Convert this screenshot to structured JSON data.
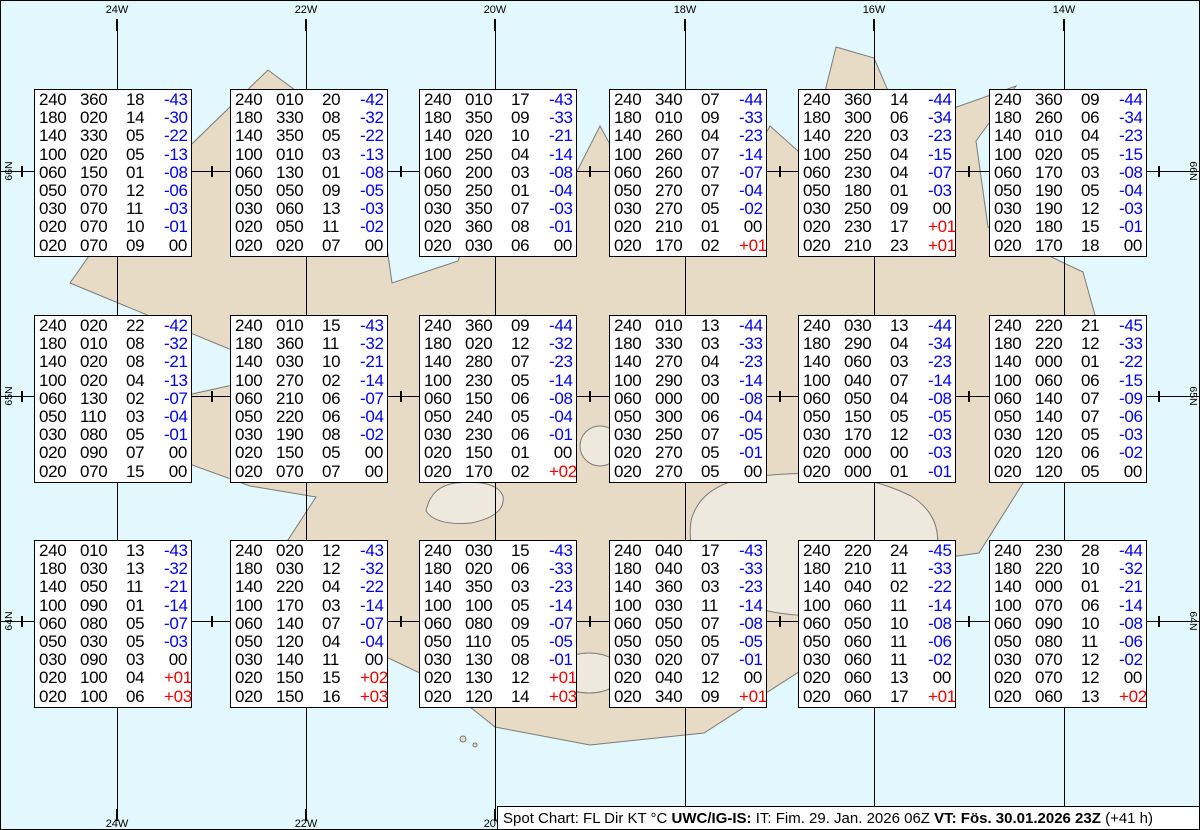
{
  "colors": {
    "ocean": "#e2f8fc",
    "land": "#e8dbc6",
    "coast": "#7a7a7a",
    "glacier": "#efe9dd",
    "grid": "#000000",
    "temp_neg": "#0000ee",
    "temp_pos": "#ee0000",
    "temp_zero": "#000000"
  },
  "grid": {
    "vlines": [
      {
        "x": 116,
        "label": "24W",
        "bottom_label": true
      },
      {
        "x": 305,
        "label": "22W",
        "bottom_label": true
      },
      {
        "x": 494,
        "label": "20W",
        "bottom_label": true
      },
      {
        "x": 684,
        "label": "18W",
        "bottom_label": false
      },
      {
        "x": 873,
        "label": "16W",
        "bottom_label": false
      },
      {
        "x": 1063,
        "label": "14W",
        "bottom_label": false
      }
    ],
    "hlines": [
      {
        "y": 170,
        "label": "66N"
      },
      {
        "y": 395,
        "label": "65N"
      },
      {
        "y": 620,
        "label": "64N"
      }
    ],
    "cross_xs": [
      21,
      211,
      400,
      589,
      779,
      968,
      1158
    ]
  },
  "boxes": [
    {
      "x": 33,
      "y": 88,
      "rows": [
        [
          "240",
          "360",
          "18",
          "-43"
        ],
        [
          "180",
          "020",
          "14",
          "-30"
        ],
        [
          "140",
          "330",
          "05",
          "-22"
        ],
        [
          "100",
          "020",
          "05",
          "-13"
        ],
        [
          "060",
          "150",
          "01",
          "-08"
        ],
        [
          "050",
          "070",
          "12",
          "-06"
        ],
        [
          "030",
          "070",
          "11",
          "-03"
        ],
        [
          "020",
          "070",
          "10",
          "-01"
        ],
        [
          "020",
          "070",
          "09",
          "00"
        ]
      ]
    },
    {
      "x": 229,
      "y": 88,
      "rows": [
        [
          "240",
          "010",
          "20",
          "-42"
        ],
        [
          "180",
          "330",
          "08",
          "-32"
        ],
        [
          "140",
          "350",
          "05",
          "-22"
        ],
        [
          "100",
          "010",
          "03",
          "-13"
        ],
        [
          "060",
          "130",
          "01",
          "-08"
        ],
        [
          "050",
          "050",
          "09",
          "-05"
        ],
        [
          "030",
          "060",
          "13",
          "-03"
        ],
        [
          "020",
          "050",
          "11",
          "-02"
        ],
        [
          "020",
          "020",
          "07",
          "00"
        ]
      ]
    },
    {
      "x": 418,
      "y": 88,
      "rows": [
        [
          "240",
          "010",
          "17",
          "-43"
        ],
        [
          "180",
          "350",
          "09",
          "-33"
        ],
        [
          "140",
          "020",
          "10",
          "-21"
        ],
        [
          "100",
          "250",
          "04",
          "-14"
        ],
        [
          "060",
          "200",
          "03",
          "-08"
        ],
        [
          "050",
          "250",
          "01",
          "-04"
        ],
        [
          "030",
          "350",
          "07",
          "-03"
        ],
        [
          "020",
          "360",
          "08",
          "-01"
        ],
        [
          "020",
          "030",
          "06",
          "00"
        ]
      ]
    },
    {
      "x": 608,
      "y": 88,
      "rows": [
        [
          "240",
          "340",
          "07",
          "-44"
        ],
        [
          "180",
          "010",
          "09",
          "-33"
        ],
        [
          "140",
          "260",
          "04",
          "-23"
        ],
        [
          "100",
          "260",
          "07",
          "-14"
        ],
        [
          "060",
          "260",
          "07",
          "-07"
        ],
        [
          "050",
          "270",
          "07",
          "-04"
        ],
        [
          "030",
          "270",
          "05",
          "-02"
        ],
        [
          "020",
          "210",
          "01",
          "00"
        ],
        [
          "020",
          "170",
          "02",
          "+01"
        ]
      ]
    },
    {
      "x": 797,
      "y": 88,
      "rows": [
        [
          "240",
          "360",
          "14",
          "-44"
        ],
        [
          "180",
          "300",
          "06",
          "-34"
        ],
        [
          "140",
          "220",
          "03",
          "-23"
        ],
        [
          "100",
          "250",
          "04",
          "-15"
        ],
        [
          "060",
          "230",
          "04",
          "-07"
        ],
        [
          "050",
          "180",
          "01",
          "-03"
        ],
        [
          "030",
          "250",
          "09",
          "00"
        ],
        [
          "020",
          "230",
          "17",
          "+01"
        ],
        [
          "020",
          "210",
          "23",
          "+01"
        ]
      ]
    },
    {
      "x": 988,
      "y": 88,
      "rows": [
        [
          "240",
          "360",
          "09",
          "-44"
        ],
        [
          "180",
          "260",
          "06",
          "-34"
        ],
        [
          "140",
          "010",
          "04",
          "-23"
        ],
        [
          "100",
          "020",
          "05",
          "-15"
        ],
        [
          "060",
          "170",
          "03",
          "-08"
        ],
        [
          "050",
          "190",
          "05",
          "-04"
        ],
        [
          "030",
          "190",
          "12",
          "-03"
        ],
        [
          "020",
          "180",
          "15",
          "-01"
        ],
        [
          "020",
          "170",
          "18",
          "00"
        ]
      ]
    },
    {
      "x": 33,
      "y": 314,
      "rows": [
        [
          "240",
          "020",
          "22",
          "-42"
        ],
        [
          "180",
          "010",
          "08",
          "-32"
        ],
        [
          "140",
          "020",
          "08",
          "-21"
        ],
        [
          "100",
          "020",
          "04",
          "-13"
        ],
        [
          "060",
          "130",
          "02",
          "-07"
        ],
        [
          "050",
          "110",
          "03",
          "-04"
        ],
        [
          "030",
          "080",
          "05",
          "-01"
        ],
        [
          "020",
          "090",
          "07",
          "00"
        ],
        [
          "020",
          "070",
          "15",
          "00"
        ]
      ]
    },
    {
      "x": 229,
      "y": 314,
      "rows": [
        [
          "240",
          "010",
          "15",
          "-43"
        ],
        [
          "180",
          "360",
          "11",
          "-32"
        ],
        [
          "140",
          "030",
          "10",
          "-21"
        ],
        [
          "100",
          "270",
          "02",
          "-14"
        ],
        [
          "060",
          "210",
          "06",
          "-07"
        ],
        [
          "050",
          "220",
          "06",
          "-04"
        ],
        [
          "030",
          "190",
          "08",
          "-02"
        ],
        [
          "020",
          "150",
          "05",
          "00"
        ],
        [
          "020",
          "070",
          "07",
          "00"
        ]
      ]
    },
    {
      "x": 418,
      "y": 314,
      "rows": [
        [
          "240",
          "360",
          "09",
          "-44"
        ],
        [
          "180",
          "020",
          "12",
          "-32"
        ],
        [
          "140",
          "280",
          "07",
          "-23"
        ],
        [
          "100",
          "230",
          "05",
          "-14"
        ],
        [
          "060",
          "150",
          "06",
          "-08"
        ],
        [
          "050",
          "240",
          "05",
          "-04"
        ],
        [
          "030",
          "230",
          "06",
          "-01"
        ],
        [
          "020",
          "150",
          "01",
          "00"
        ],
        [
          "020",
          "170",
          "02",
          "+02"
        ]
      ]
    },
    {
      "x": 608,
      "y": 314,
      "rows": [
        [
          "240",
          "010",
          "13",
          "-44"
        ],
        [
          "180",
          "330",
          "03",
          "-33"
        ],
        [
          "140",
          "270",
          "04",
          "-23"
        ],
        [
          "100",
          "290",
          "03",
          "-14"
        ],
        [
          "060",
          "000",
          "00",
          "-08"
        ],
        [
          "050",
          "300",
          "06",
          "-04"
        ],
        [
          "030",
          "250",
          "07",
          "-05"
        ],
        [
          "020",
          "270",
          "05",
          "-01"
        ],
        [
          "020",
          "270",
          "05",
          "00"
        ]
      ]
    },
    {
      "x": 797,
      "y": 314,
      "rows": [
        [
          "240",
          "030",
          "13",
          "-44"
        ],
        [
          "180",
          "290",
          "04",
          "-34"
        ],
        [
          "140",
          "060",
          "03",
          "-23"
        ],
        [
          "100",
          "040",
          "07",
          "-14"
        ],
        [
          "060",
          "050",
          "04",
          "-08"
        ],
        [
          "050",
          "150",
          "05",
          "-05"
        ],
        [
          "030",
          "170",
          "12",
          "-03"
        ],
        [
          "020",
          "000",
          "00",
          "-03"
        ],
        [
          "020",
          "000",
          "01",
          "-01"
        ]
      ]
    },
    {
      "x": 988,
      "y": 314,
      "rows": [
        [
          "240",
          "220",
          "21",
          "-45"
        ],
        [
          "180",
          "220",
          "12",
          "-33"
        ],
        [
          "140",
          "000",
          "01",
          "-22"
        ],
        [
          "100",
          "060",
          "06",
          "-15"
        ],
        [
          "060",
          "140",
          "07",
          "-09"
        ],
        [
          "050",
          "140",
          "07",
          "-06"
        ],
        [
          "030",
          "120",
          "05",
          "-03"
        ],
        [
          "020",
          "120",
          "06",
          "-02"
        ],
        [
          "020",
          "120",
          "05",
          "00"
        ]
      ]
    },
    {
      "x": 33,
      "y": 539,
      "rows": [
        [
          "240",
          "010",
          "13",
          "-43"
        ],
        [
          "180",
          "030",
          "13",
          "-32"
        ],
        [
          "140",
          "050",
          "11",
          "-21"
        ],
        [
          "100",
          "090",
          "01",
          "-14"
        ],
        [
          "060",
          "080",
          "05",
          "-07"
        ],
        [
          "050",
          "030",
          "05",
          "-03"
        ],
        [
          "030",
          "090",
          "03",
          "00"
        ],
        [
          "020",
          "100",
          "04",
          "+01"
        ],
        [
          "020",
          "100",
          "06",
          "+03"
        ]
      ]
    },
    {
      "x": 229,
      "y": 539,
      "rows": [
        [
          "240",
          "020",
          "12",
          "-43"
        ],
        [
          "180",
          "030",
          "12",
          "-32"
        ],
        [
          "140",
          "220",
          "04",
          "-22"
        ],
        [
          "100",
          "170",
          "03",
          "-14"
        ],
        [
          "060",
          "140",
          "07",
          "-07"
        ],
        [
          "050",
          "120",
          "04",
          "-04"
        ],
        [
          "030",
          "140",
          "11",
          "00"
        ],
        [
          "020",
          "150",
          "15",
          "+02"
        ],
        [
          "020",
          "150",
          "16",
          "+03"
        ]
      ]
    },
    {
      "x": 418,
      "y": 539,
      "rows": [
        [
          "240",
          "030",
          "15",
          "-43"
        ],
        [
          "180",
          "020",
          "06",
          "-33"
        ],
        [
          "140",
          "350",
          "03",
          "-23"
        ],
        [
          "100",
          "100",
          "05",
          "-14"
        ],
        [
          "060",
          "080",
          "09",
          "-07"
        ],
        [
          "050",
          "110",
          "05",
          "-05"
        ],
        [
          "030",
          "130",
          "08",
          "-01"
        ],
        [
          "020",
          "130",
          "12",
          "+01"
        ],
        [
          "020",
          "120",
          "14",
          "+03"
        ]
      ]
    },
    {
      "x": 608,
      "y": 539,
      "rows": [
        [
          "240",
          "040",
          "17",
          "-43"
        ],
        [
          "180",
          "040",
          "03",
          "-33"
        ],
        [
          "140",
          "360",
          "03",
          "-23"
        ],
        [
          "100",
          "030",
          "11",
          "-14"
        ],
        [
          "060",
          "050",
          "07",
          "-08"
        ],
        [
          "050",
          "050",
          "05",
          "-05"
        ],
        [
          "030",
          "020",
          "07",
          "-01"
        ],
        [
          "020",
          "040",
          "12",
          "00"
        ],
        [
          "020",
          "340",
          "09",
          "+01"
        ]
      ]
    },
    {
      "x": 797,
      "y": 539,
      "rows": [
        [
          "240",
          "220",
          "24",
          "-45"
        ],
        [
          "180",
          "210",
          "11",
          "-33"
        ],
        [
          "140",
          "040",
          "02",
          "-22"
        ],
        [
          "100",
          "060",
          "11",
          "-14"
        ],
        [
          "060",
          "050",
          "10",
          "-08"
        ],
        [
          "050",
          "060",
          "11",
          "-06"
        ],
        [
          "030",
          "060",
          "11",
          "-02"
        ],
        [
          "020",
          "060",
          "13",
          "00"
        ],
        [
          "020",
          "060",
          "17",
          "+01"
        ]
      ]
    },
    {
      "x": 988,
      "y": 539,
      "rows": [
        [
          "240",
          "230",
          "28",
          "-44"
        ],
        [
          "180",
          "220",
          "10",
          "-32"
        ],
        [
          "140",
          "000",
          "01",
          "-21"
        ],
        [
          "100",
          "070",
          "06",
          "-14"
        ],
        [
          "060",
          "090",
          "10",
          "-08"
        ],
        [
          "050",
          "080",
          "11",
          "-06"
        ],
        [
          "030",
          "070",
          "12",
          "-02"
        ],
        [
          "020",
          "070",
          "12",
          "00"
        ],
        [
          "020",
          "060",
          "13",
          "+02"
        ]
      ]
    }
  ],
  "statusbar": {
    "prefix": "Spot Chart: FL Dir KT °C ",
    "org": "UWC/IG-IS:",
    "issue": " IT: Fim. 29. Jan. 2026 06Z ",
    "valid": "VT: Fös. 30.01.2026 23Z",
    "offset": " (+41 h)"
  }
}
